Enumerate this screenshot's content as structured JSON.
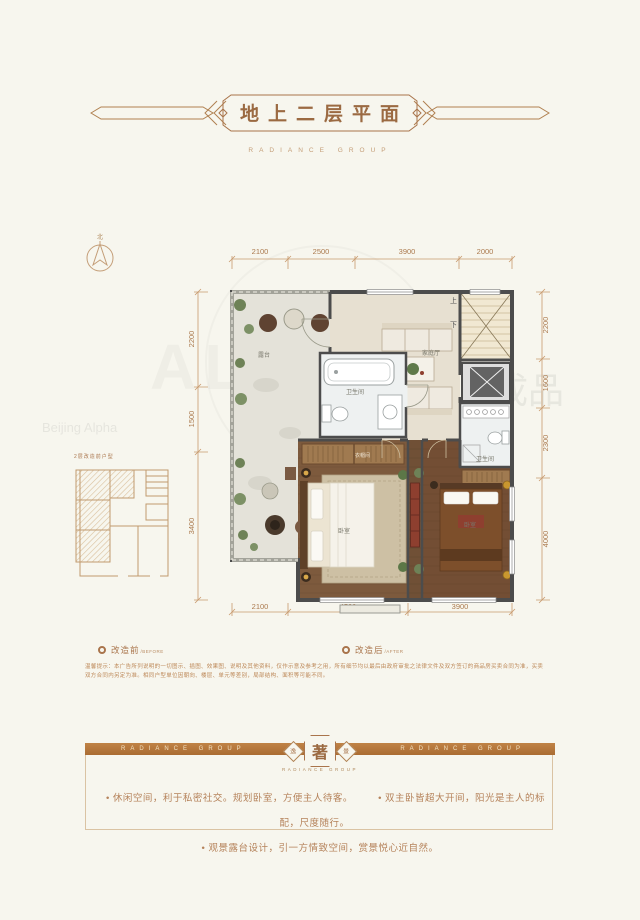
{
  "header": {
    "title": "地上二层平面",
    "subtitle": "RADIANCE GROUP"
  },
  "compass": {
    "north_label": "北"
  },
  "plan": {
    "dims": {
      "top": [
        "2100",
        "2500",
        "3900",
        "2000"
      ],
      "bottom": [
        "2100",
        "4500",
        "3900"
      ],
      "left": [
        "2200",
        "1500",
        "3400"
      ],
      "right": [
        "2200",
        "1600",
        "2300",
        "4000"
      ]
    },
    "rooms": {
      "terrace": "露台",
      "family": "家庭厅",
      "bath1": "卫生间",
      "bath2": "卫生间",
      "bed1": "卧室",
      "bed2": "卧室",
      "cloak": "衣帽间",
      "stair_up": "上",
      "stair_down": "下"
    }
  },
  "inset": {
    "caption": "2层改造前户型"
  },
  "legend": {
    "before": {
      "label": "改造前",
      "sub": "/BEFORE"
    },
    "after": {
      "label": "改造后",
      "sub": "/AFTER"
    }
  },
  "disclaimer": {
    "line1": "温馨提示：本广告所列说明的一切图示、插图、效果图、说明及其他资料，仅作示意及参考之用，所有细节均以最后由政府审批之法律文件及双方签订的商品房买卖合同为准，买卖",
    "line2": "双方合同内另定为准。相同户型单位因朝向、楼层、单元等差别，局部结构、面积等可能不同。"
  },
  "banner": {
    "left": "RADIANCE GROUP",
    "right": "RADIANCE GROUP",
    "emblem": {
      "left": "逸",
      "center": "著",
      "right": "景"
    },
    "sub": "RADIANCE GROUP"
  },
  "features": {
    "bullets": [
      "• 休闲空间，利于私密社交。规划卧室，方便主人待客。",
      "• 双主卧皆超大开间，阳光是主人的标配，尺度随行。",
      "• 观景露台设计，引一方情致空间，赏景悦心近自然。"
    ]
  },
  "watermark": {
    "t1": "Beijing Alpha",
    "t2": "科技有限公司",
    "t3": "成品"
  }
}
